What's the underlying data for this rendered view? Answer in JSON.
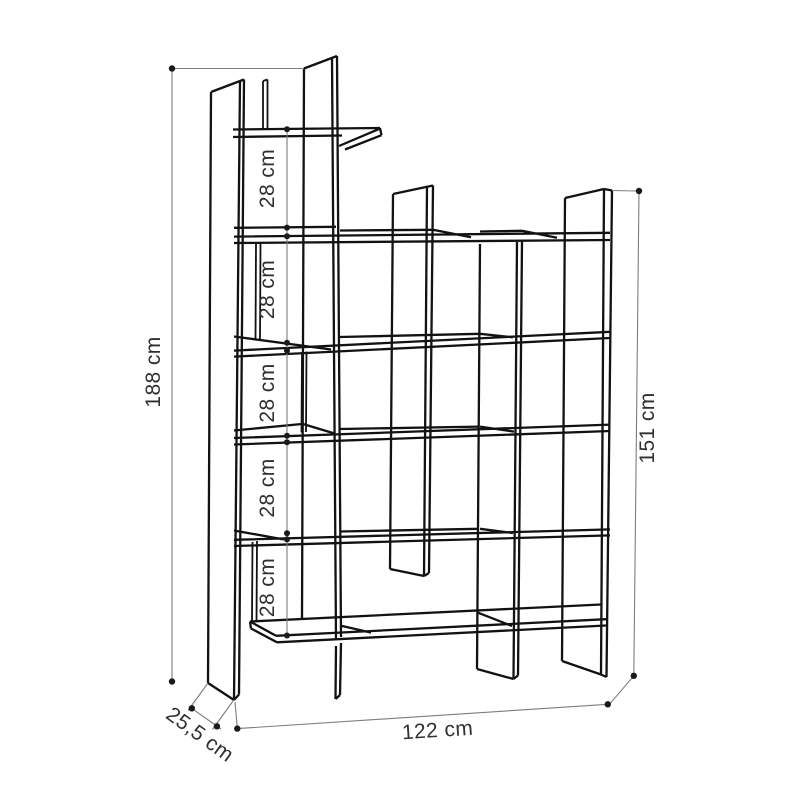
{
  "diagram": {
    "type": "furniture-dimension-drawing",
    "object": "staggered-bookshelf",
    "dimensions": {
      "total_height": {
        "label": "188 cm",
        "orientation": "vertical-left"
      },
      "right_height": {
        "label": "151 cm",
        "orientation": "vertical-right"
      },
      "width": {
        "label": "122 cm",
        "orientation": "horizontal-bottom"
      },
      "depth": {
        "label": "25,5 cm",
        "orientation": "diagonal-bottom-left"
      },
      "shelf_gaps": [
        {
          "label": "28 cm"
        },
        {
          "label": "28 cm"
        },
        {
          "label": "28 cm"
        },
        {
          "label": "28 cm"
        },
        {
          "label": "28 cm"
        }
      ]
    },
    "colors": {
      "background": "#ffffff",
      "furniture_line": "#121212",
      "dimension_line": "#7d7d7d",
      "text": "#303030"
    }
  }
}
